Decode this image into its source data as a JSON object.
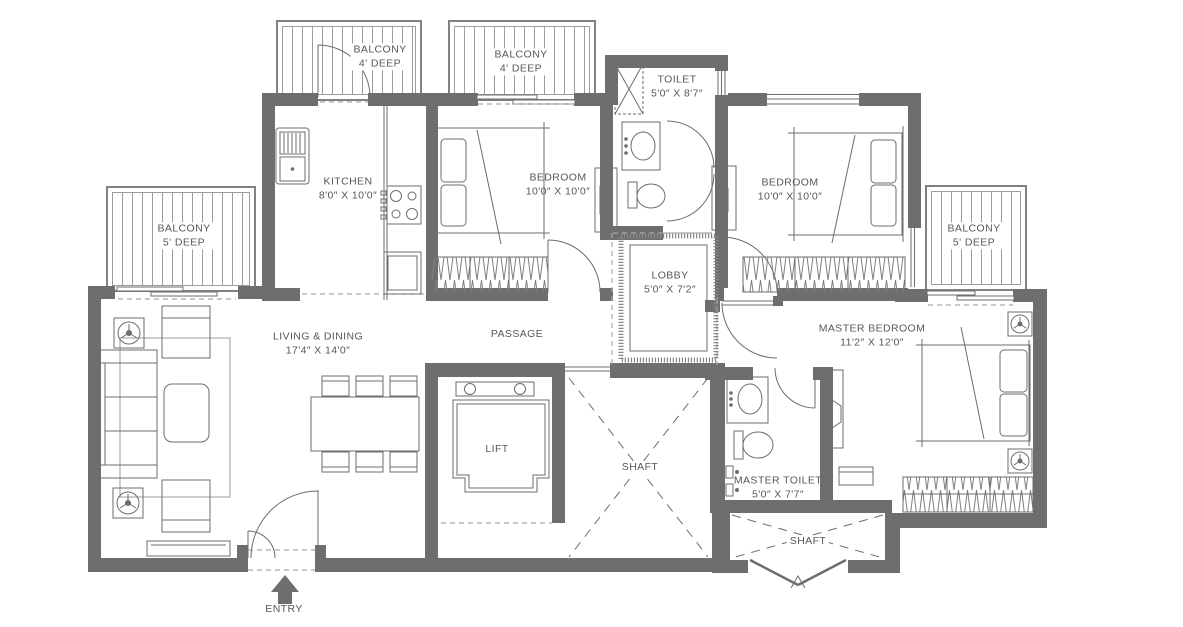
{
  "rooms": [
    {
      "id": "balcony-top-left",
      "label": "BALCONY",
      "dims": "4' DEEP"
    },
    {
      "id": "balcony-top-mid",
      "label": "BALCONY",
      "dims": "4' DEEP"
    },
    {
      "id": "toilet",
      "label": "TOILET",
      "dims": "5'0″ X 8'7″"
    },
    {
      "id": "kitchen",
      "label": "KITCHEN",
      "dims": "8'0″ X 10'0″"
    },
    {
      "id": "bedroom-1",
      "label": "BEDROOM",
      "dims": "10'0″ X 10'0″"
    },
    {
      "id": "bedroom-2",
      "label": "BEDROOM",
      "dims": "10'0″ X 10'0″"
    },
    {
      "id": "balcony-left",
      "label": "BALCONY",
      "dims": "5' DEEP"
    },
    {
      "id": "balcony-right",
      "label": "BALCONY",
      "dims": "5' DEEP"
    },
    {
      "id": "lobby",
      "label": "LOBBY",
      "dims": "5'0″ X 7'2″"
    },
    {
      "id": "living-dining",
      "label": "LIVING & DINING",
      "dims": "17'4″ X 14'0″"
    },
    {
      "id": "passage",
      "label": "PASSAGE",
      "dims": ""
    },
    {
      "id": "master-bedroom",
      "label": "MASTER BEDROOM",
      "dims": "11'2″ X 12'0″"
    },
    {
      "id": "lift",
      "label": "LIFT",
      "dims": ""
    },
    {
      "id": "shaft-main",
      "label": "SHAFT",
      "dims": ""
    },
    {
      "id": "master-toilet",
      "label": "MASTER TOILET",
      "dims": "5'0″ X 7'7″"
    },
    {
      "id": "shaft-bottom",
      "label": "SHAFT",
      "dims": ""
    },
    {
      "id": "entry",
      "label": "ENTRY",
      "dims": ""
    }
  ],
  "colors": {
    "wall": "#6e6e6e",
    "line": "#6b6d6f",
    "text": "#55575a",
    "dash": "#a7a9ac",
    "rail": "#9a9c9e"
  }
}
